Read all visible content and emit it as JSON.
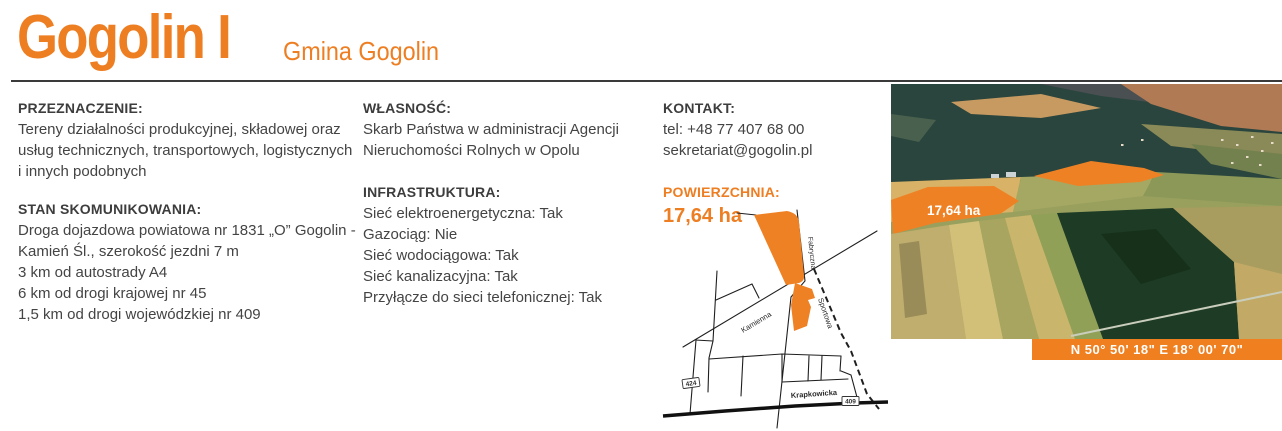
{
  "theme": {
    "accent": "#ee7e22",
    "text_dark": "#3d3d3d",
    "line": "#3a3a3a"
  },
  "header": {
    "title": "Gogolin I",
    "subtitle": "Gmina Gogolin"
  },
  "sections": {
    "przeznaczenie": {
      "heading": "PRZEZNACZENIE:",
      "lines": [
        "Tereny działalności produkcyjnej, składowej oraz",
        "usług technicznych, transportowych, logistycznych",
        "i innych podobnych"
      ]
    },
    "stan": {
      "heading": "STAN SKOMUNIKOWANIA:",
      "lines": [
        "Droga dojazdowa powiatowa nr 1831 „O” Gogolin -",
        "Kamień Śl., szerokość jezdni 7 m",
        "3 km od autostrady A4",
        "6 km od drogi krajowej nr 45",
        "1,5 km od drogi wojewódzkiej nr 409"
      ]
    },
    "wlasnosc": {
      "heading": "WŁASNOŚĆ:",
      "lines": [
        "Skarb Państwa w administracji Agencji",
        "Nieruchomości Rolnych w Opolu"
      ]
    },
    "infrastruktura": {
      "heading": "INFRASTRUKTURA:",
      "lines": [
        "Sieć elektroenergetyczna: Tak",
        "Gazociąg: Nie",
        "Sieć wodociągowa: Tak",
        "Sieć kanalizacyjna: Tak",
        "Przyłącze do sieci telefonicznej: Tak"
      ]
    },
    "kontakt": {
      "heading": "KONTAKT:",
      "lines": [
        "tel: +48 77 407 68 00",
        "sekretariat@gogolin.pl"
      ]
    },
    "powierzchnia": {
      "heading": "POWIERZCHNIA:",
      "value": "17,64 ha"
    }
  },
  "map": {
    "labels": {
      "fabryczna": "Fabryczna",
      "kamienna": "Kamienna",
      "sportowa": "Sportowa",
      "krapkowicka": "Krapkowicka"
    },
    "badges": {
      "left": "424",
      "right": "409"
    }
  },
  "photo": {
    "area_label": "17,64 ha",
    "coordinates": "N 50° 50' 18\" E 18° 00' 70\""
  }
}
